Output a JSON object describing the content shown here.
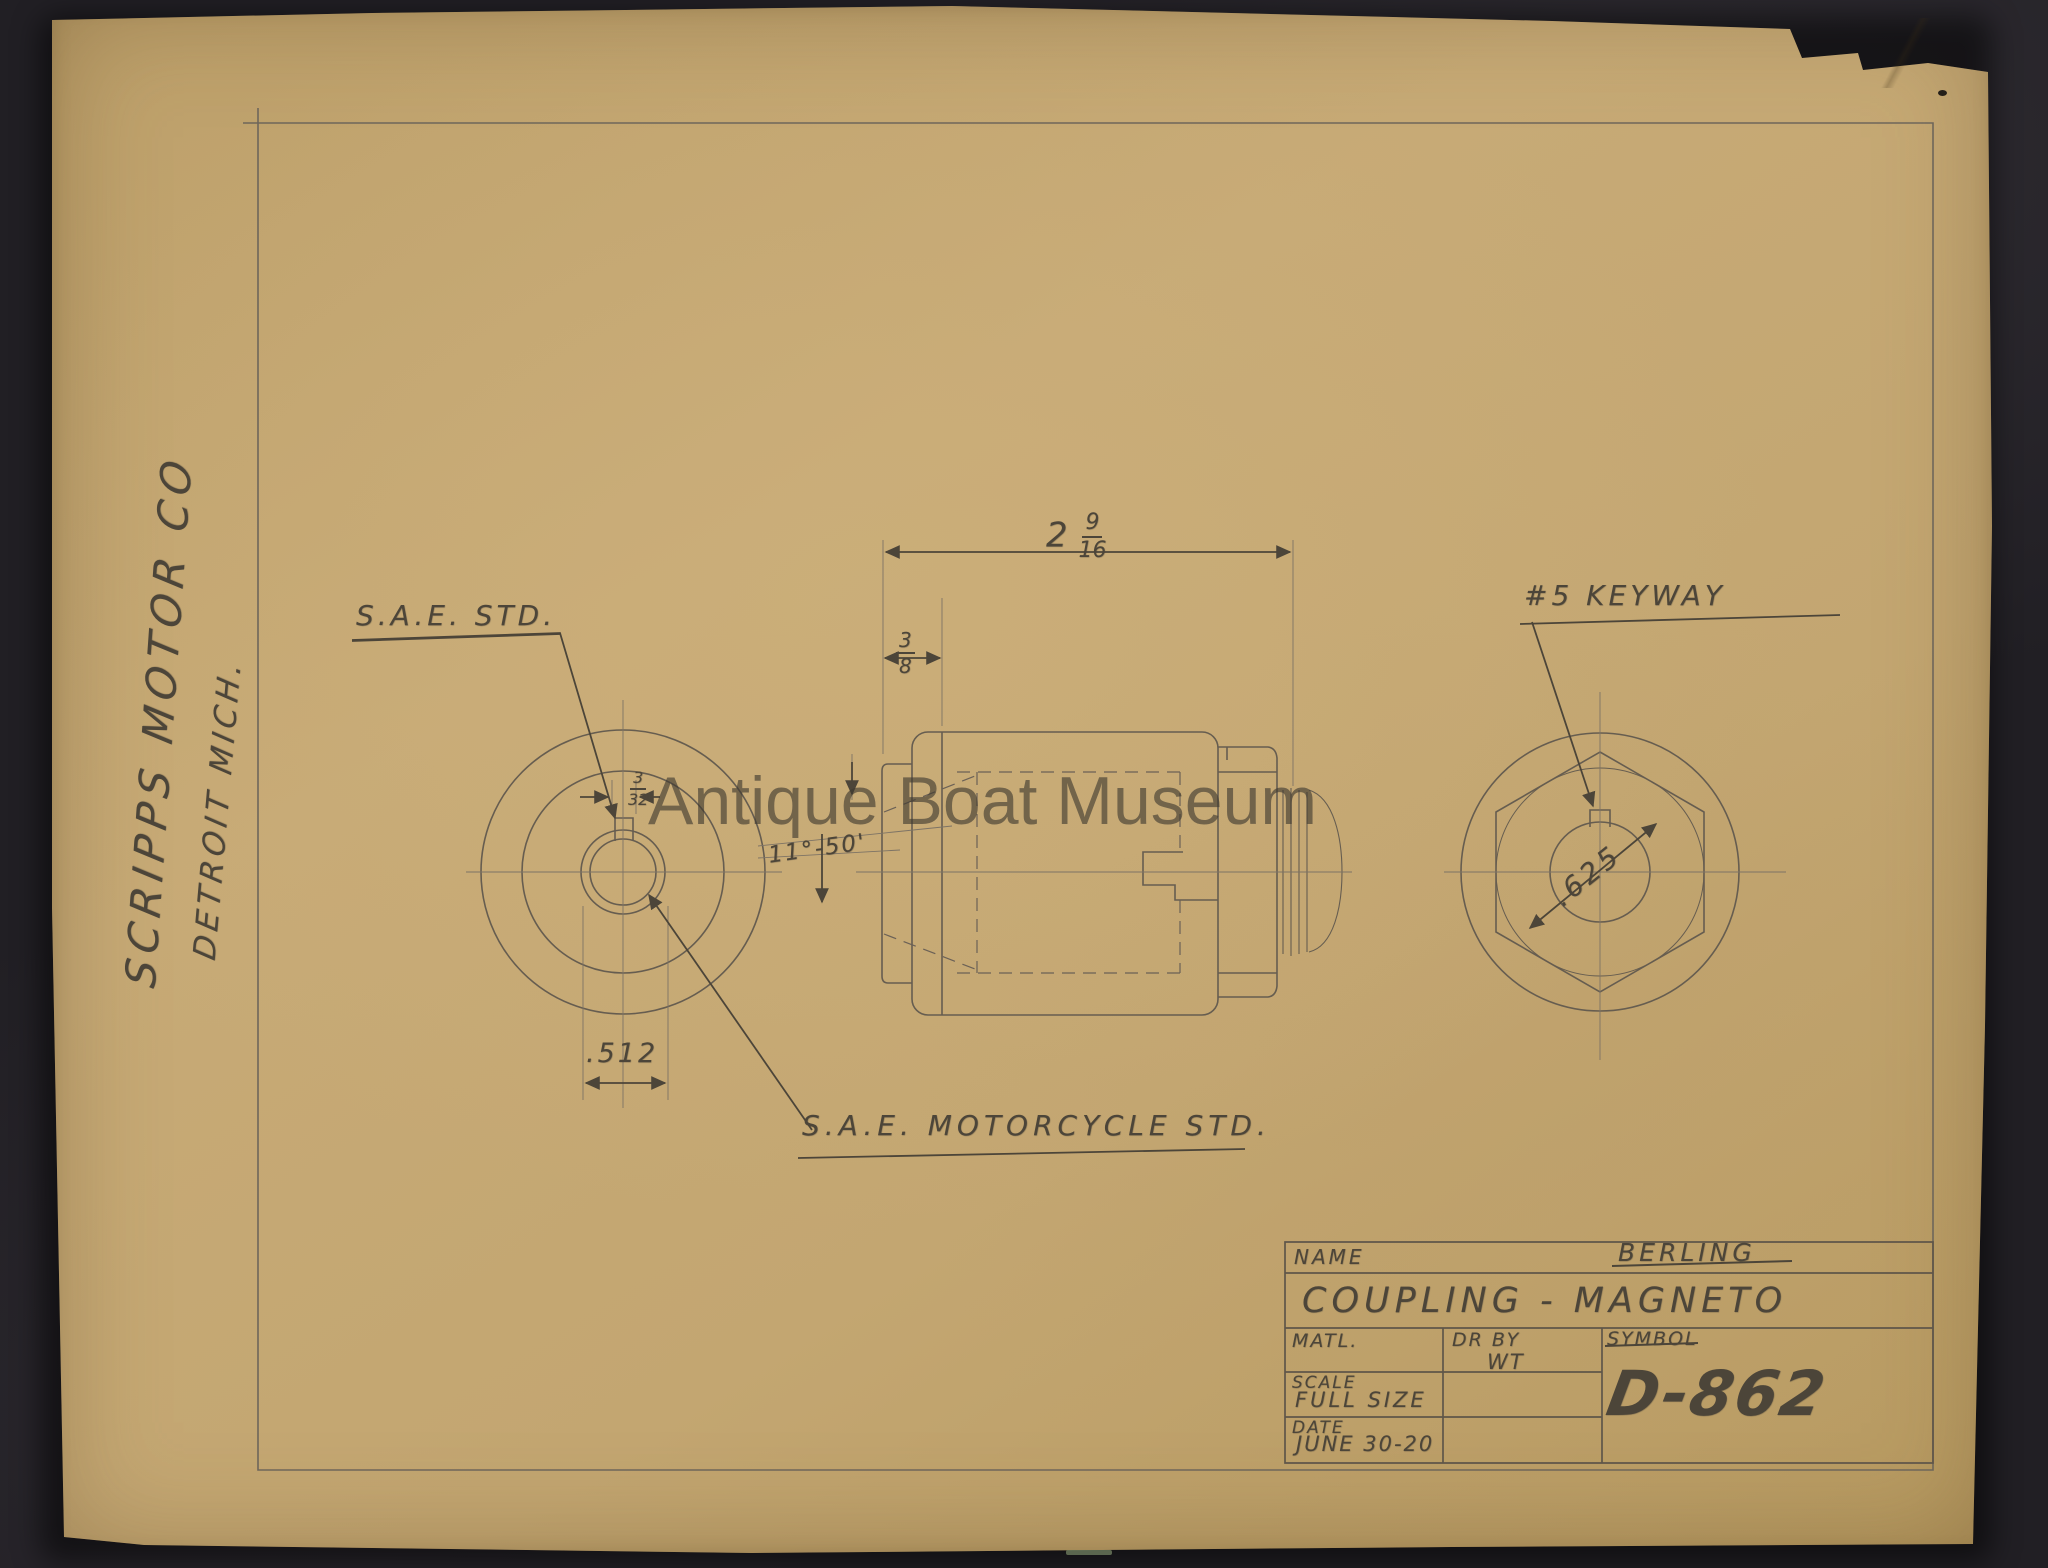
{
  "watermark": {
    "text": "Antique Boat Museum"
  },
  "margin_note": {
    "company": "SCRIPPS MOTOR CO",
    "city": "DETROIT MICH."
  },
  "annotations": {
    "sae_std": "S.A.E. STD.",
    "sae_motorcycle_std": "S.A.E. MOTORCYCLE STD.",
    "keyway_note": "#5 KEYWAY",
    "angle": "11°-50'",
    "bore_dia": ".512",
    "shaft_dia": ".625",
    "overall_len": {
      "whole": "2",
      "num": "9",
      "den": "16"
    },
    "flange_len": {
      "num": "3",
      "den": "8"
    },
    "keyway_width": {
      "num": "3",
      "den": "32"
    }
  },
  "title_block": {
    "name_label": "NAME",
    "maker": "BERLING",
    "part_title": "COUPLING - MAGNETO",
    "matl_label": "MATL.",
    "drby_label": "DR BY",
    "drby_value": "WT",
    "symbol_label": "SYMBOL",
    "scale_label": "SCALE",
    "scale_value": "FULL SIZE",
    "date_label": "DATE",
    "date_value": "JUNE 30-20",
    "drawing_number": "D-862"
  },
  "colors": {
    "background": "#211f24",
    "paper": "#c3a671",
    "pencil_line": "#6b6156",
    "pencil_ink": "#4c4539",
    "watermark": "#3e3930"
  }
}
